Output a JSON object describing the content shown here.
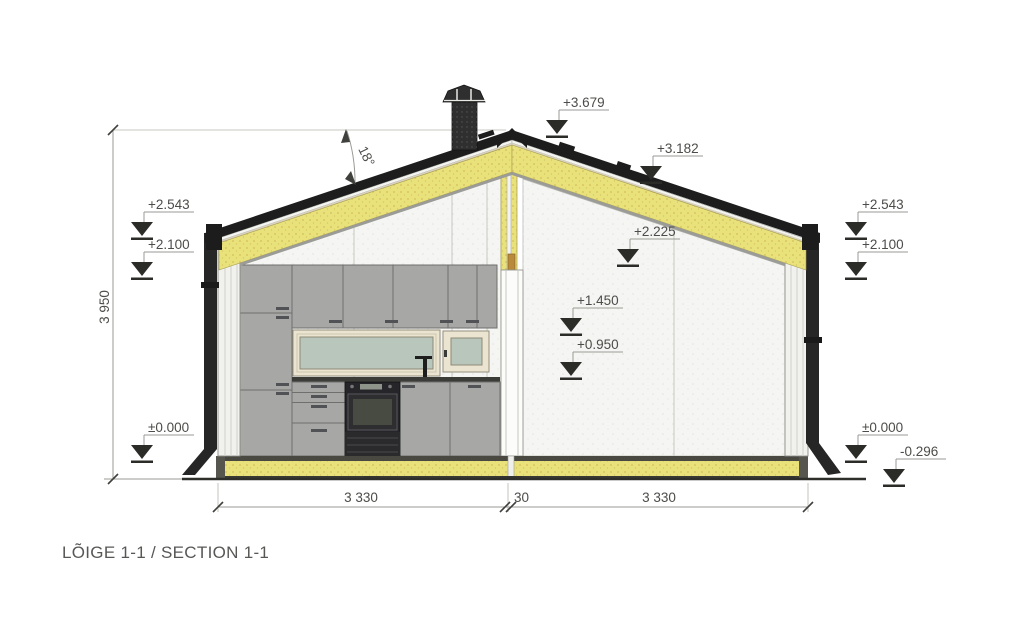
{
  "title": "LÕIGE 1-1 / SECTION 1-1",
  "annotations": {
    "roof_angle": "18°",
    "height_dim": "3 950",
    "width_dims": [
      "3 330",
      "30",
      "3 330"
    ],
    "markers": [
      {
        "label": "+3.679",
        "location": "ridge"
      },
      {
        "label": "+3.182",
        "location": "right-roof-slope"
      },
      {
        "label": "+2.543",
        "location": "left-eave-outside"
      },
      {
        "label": "+2.100",
        "location": "left-wall-outside"
      },
      {
        "label": "+2.543",
        "location": "right-eave-outside"
      },
      {
        "label": "+2.100",
        "location": "right-wall-outside"
      },
      {
        "label": "+2.225",
        "location": "right-room-ceiling"
      },
      {
        "label": "+1.450",
        "location": "right-room-wall"
      },
      {
        "label": "+0.950",
        "location": "right-room-wall"
      },
      {
        "label": "±0.000",
        "location": "floor-level-left"
      },
      {
        "label": "±0.000",
        "location": "floor-level-right"
      },
      {
        "label": "-0.296",
        "location": "ground-level"
      }
    ]
  },
  "colors": {
    "insulation_yellow": "#e9e27b",
    "insulation_speckle": "#c8a94e",
    "roof_black": "#1d1d1d",
    "cabinet_gray": "#a7a8a6",
    "glass_green": "#b9c6bb",
    "window_frame_cream": "#ebe4d1",
    "wall_white": "#f1f1ee",
    "annotation_gray": "#4c4c49"
  }
}
